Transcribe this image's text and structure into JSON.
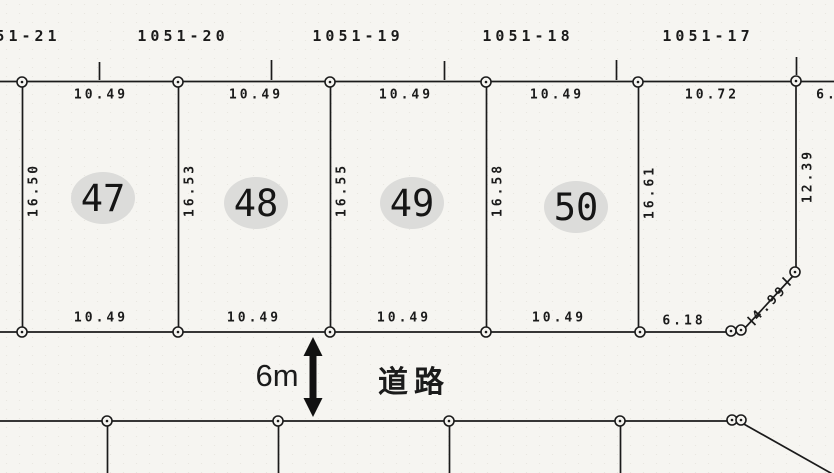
{
  "document": {
    "type": "cadastral-survey-map",
    "colors": {
      "ink": "#1b1b1b",
      "paper": "#f6f5f1",
      "plot_highlight": "#dcdcda"
    }
  },
  "upper_lots": {
    "labels": [
      "51-21",
      "1051-20",
      "1051-19",
      "1051-18",
      "1051-17"
    ]
  },
  "plots": [
    {
      "number": "47",
      "top_dim": "10.49",
      "bottom_dim": "10.49",
      "left_dim": "16.50"
    },
    {
      "number": "48",
      "top_dim": "10.49",
      "bottom_dim": "10.49",
      "left_dim": "16.53"
    },
    {
      "number": "49",
      "top_dim": "10.49",
      "bottom_dim": "10.49",
      "left_dim": "16.55"
    },
    {
      "number": "50",
      "top_dim": "10.49",
      "bottom_dim": "10.49",
      "left_dim": "16.58"
    }
  ],
  "right_parcel": {
    "top_dim": "10.72",
    "left_dim": "16.61",
    "right_dim": "12.39",
    "bottom_dim": "6.18",
    "diagonal_dim": "4.99",
    "top_right_partial_dim": "6."
  },
  "road": {
    "width_label": "6m",
    "name_label": "道路"
  }
}
